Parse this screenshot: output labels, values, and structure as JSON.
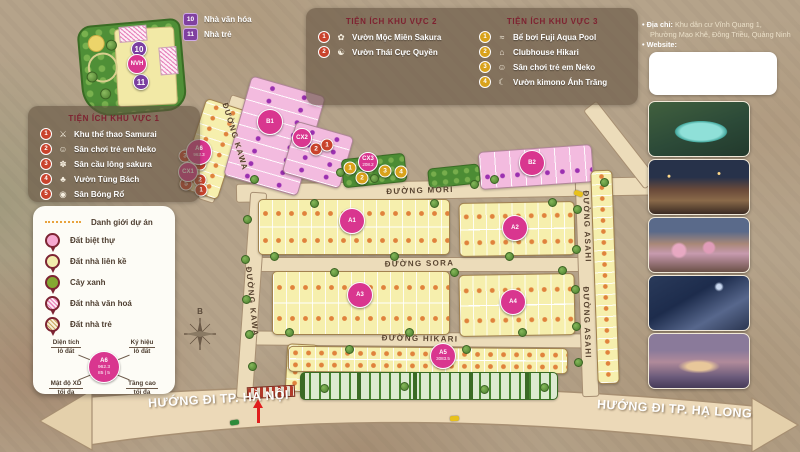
{
  "colors": {
    "accent_magenta": "#d9368f",
    "lot_yellow": "#f6efad",
    "villa_pink": "#f3bbdf",
    "green": "#4c8c34",
    "marker_red": "#c9432c",
    "marker_gold": "#d9a21b",
    "purple": "#8040a0",
    "road": "#ecdcba"
  },
  "mini_legend": {
    "items": [
      {
        "num": "10",
        "label": "Nhà văn hóa"
      },
      {
        "num": "11",
        "label": "Nhà trẻ"
      }
    ]
  },
  "kv1": {
    "title": "TIỆN ÍCH KHU VỰC 1",
    "items": [
      {
        "num": "1",
        "icon": "⚔",
        "label": "Khu thể thao Samurai"
      },
      {
        "num": "2",
        "icon": "☺",
        "label": "Sân chơi trẻ em Neko"
      },
      {
        "num": "3",
        "icon": "✽",
        "label": "Sân cầu lông sakura"
      },
      {
        "num": "4",
        "icon": "♣",
        "label": "Vườn Tùng Bách"
      },
      {
        "num": "5",
        "icon": "◉",
        "label": "Sân Bóng Rổ"
      }
    ]
  },
  "kv2": {
    "title": "TIỆN ÍCH KHU VỰC 2",
    "items": [
      {
        "num": "1",
        "icon": "✿",
        "label": "Vườn Mộc Miên Sakura"
      },
      {
        "num": "2",
        "icon": "☯",
        "label": "Vườn Thái Cực Quyền"
      }
    ]
  },
  "kv3": {
    "title": "TIỆN ÍCH KHU VỰC 3",
    "items": [
      {
        "num": "1",
        "icon": "≈",
        "label": "Bể bơi Fuji Aqua Pool"
      },
      {
        "num": "2",
        "icon": "⌂",
        "label": "Clubhouse Hikari"
      },
      {
        "num": "3",
        "icon": "☺",
        "label": "Sân chơi trẻ em Neko"
      },
      {
        "num": "4",
        "icon": "☾",
        "label": "Vườn kimono Ánh Trăng"
      }
    ]
  },
  "map_legend": {
    "boundary_label": "Danh giới dự án",
    "items": [
      {
        "label": "Đất biệt thự"
      },
      {
        "label": "Đất nhà liên kề"
      },
      {
        "label": "Cây xanh"
      },
      {
        "label": "Đất nhà văn hoá"
      },
      {
        "label": "Đất nhà trẻ"
      }
    ],
    "diagram": {
      "code": "A6",
      "area": "962.3",
      "density": "85",
      "floors": "5",
      "tl1": "Diện tích",
      "tl2": "lô đất",
      "tr1": "Ký hiệu",
      "tr2": "lô đất",
      "bl1": "Mật độ XD",
      "bl2": "tối đa",
      "br1": "Tầng cao",
      "br2": "tối đa"
    }
  },
  "info": {
    "address_label": "Địa chỉ:",
    "address_line1": "Khu dân cư Vĩnh Quang 1,",
    "address_line2": "Phường Mạo Khê, Đông Triều, Quảng Ninh",
    "website_label": "Website:"
  },
  "map": {
    "streets": {
      "mori": "ĐƯỜNG MORI",
      "sora": "ĐƯỜNG SORA",
      "hikari": "ĐƯỜNG HIKARI",
      "kawa": "ĐƯỜNG KAWA",
      "asahi": "ĐƯỜNG ASAHI"
    },
    "directions": {
      "left": "HƯỚNG ĐI TP. HÀ NỘI",
      "right": "HƯỚNG ĐI TP. HẠ LONG"
    },
    "compass": "B",
    "blocks": [
      {
        "label": "A1",
        "cls": "big",
        "x": 352,
        "y": 221
      },
      {
        "label": "A2",
        "cls": "big",
        "x": 515,
        "y": 228
      },
      {
        "label": "A3",
        "cls": "big",
        "x": 360,
        "y": 295
      },
      {
        "label": "A4",
        "cls": "big",
        "x": 513,
        "y": 302
      },
      {
        "label": "A5",
        "sub": "3083.5",
        "cls": "big",
        "x": 443,
        "y": 356
      },
      {
        "label": "A6",
        "sub": "962.3",
        "cls": "big",
        "x": 199,
        "y": 152
      },
      {
        "label": "B1",
        "cls": "big",
        "x": 270,
        "y": 122
      },
      {
        "label": "B2",
        "cls": "big",
        "x": 532,
        "y": 163
      },
      {
        "label": "CX1",
        "cls": "small",
        "x": 188,
        "y": 172
      },
      {
        "label": "CX2",
        "cls": "small",
        "x": 302,
        "y": 138
      },
      {
        "label": "CX3",
        "sub": "208.2",
        "cls": "small",
        "x": 368,
        "y": 162
      },
      {
        "label": "NVH",
        "cls": "small",
        "x": 137,
        "y": 64
      }
    ],
    "markers": [
      {
        "n": "3",
        "kind": "kv1",
        "x": 185,
        "y": 156
      },
      {
        "n": "4",
        "kind": "kv1",
        "x": 200,
        "y": 164
      },
      {
        "n": "2",
        "kind": "kv1",
        "x": 200,
        "y": 180
      },
      {
        "n": "1",
        "kind": "kv1",
        "x": 201,
        "y": 190
      },
      {
        "n": "5",
        "kind": "kv1",
        "x": 186,
        "y": 184
      },
      {
        "n": "2",
        "kind": "kv2",
        "x": 316,
        "y": 149
      },
      {
        "n": "1",
        "kind": "kv2",
        "x": 327,
        "y": 145
      },
      {
        "n": "1",
        "kind": "kv3",
        "x": 350,
        "y": 168
      },
      {
        "n": "2",
        "kind": "kv3",
        "x": 362,
        "y": 178
      },
      {
        "n": "3",
        "kind": "kv3",
        "x": 385,
        "y": 171
      },
      {
        "n": "4",
        "kind": "kv3",
        "x": 401,
        "y": 172
      },
      {
        "n": "10",
        "kind": "park",
        "x": 139,
        "y": 49
      },
      {
        "n": "11",
        "kind": "park",
        "x": 141,
        "y": 82
      }
    ]
  }
}
